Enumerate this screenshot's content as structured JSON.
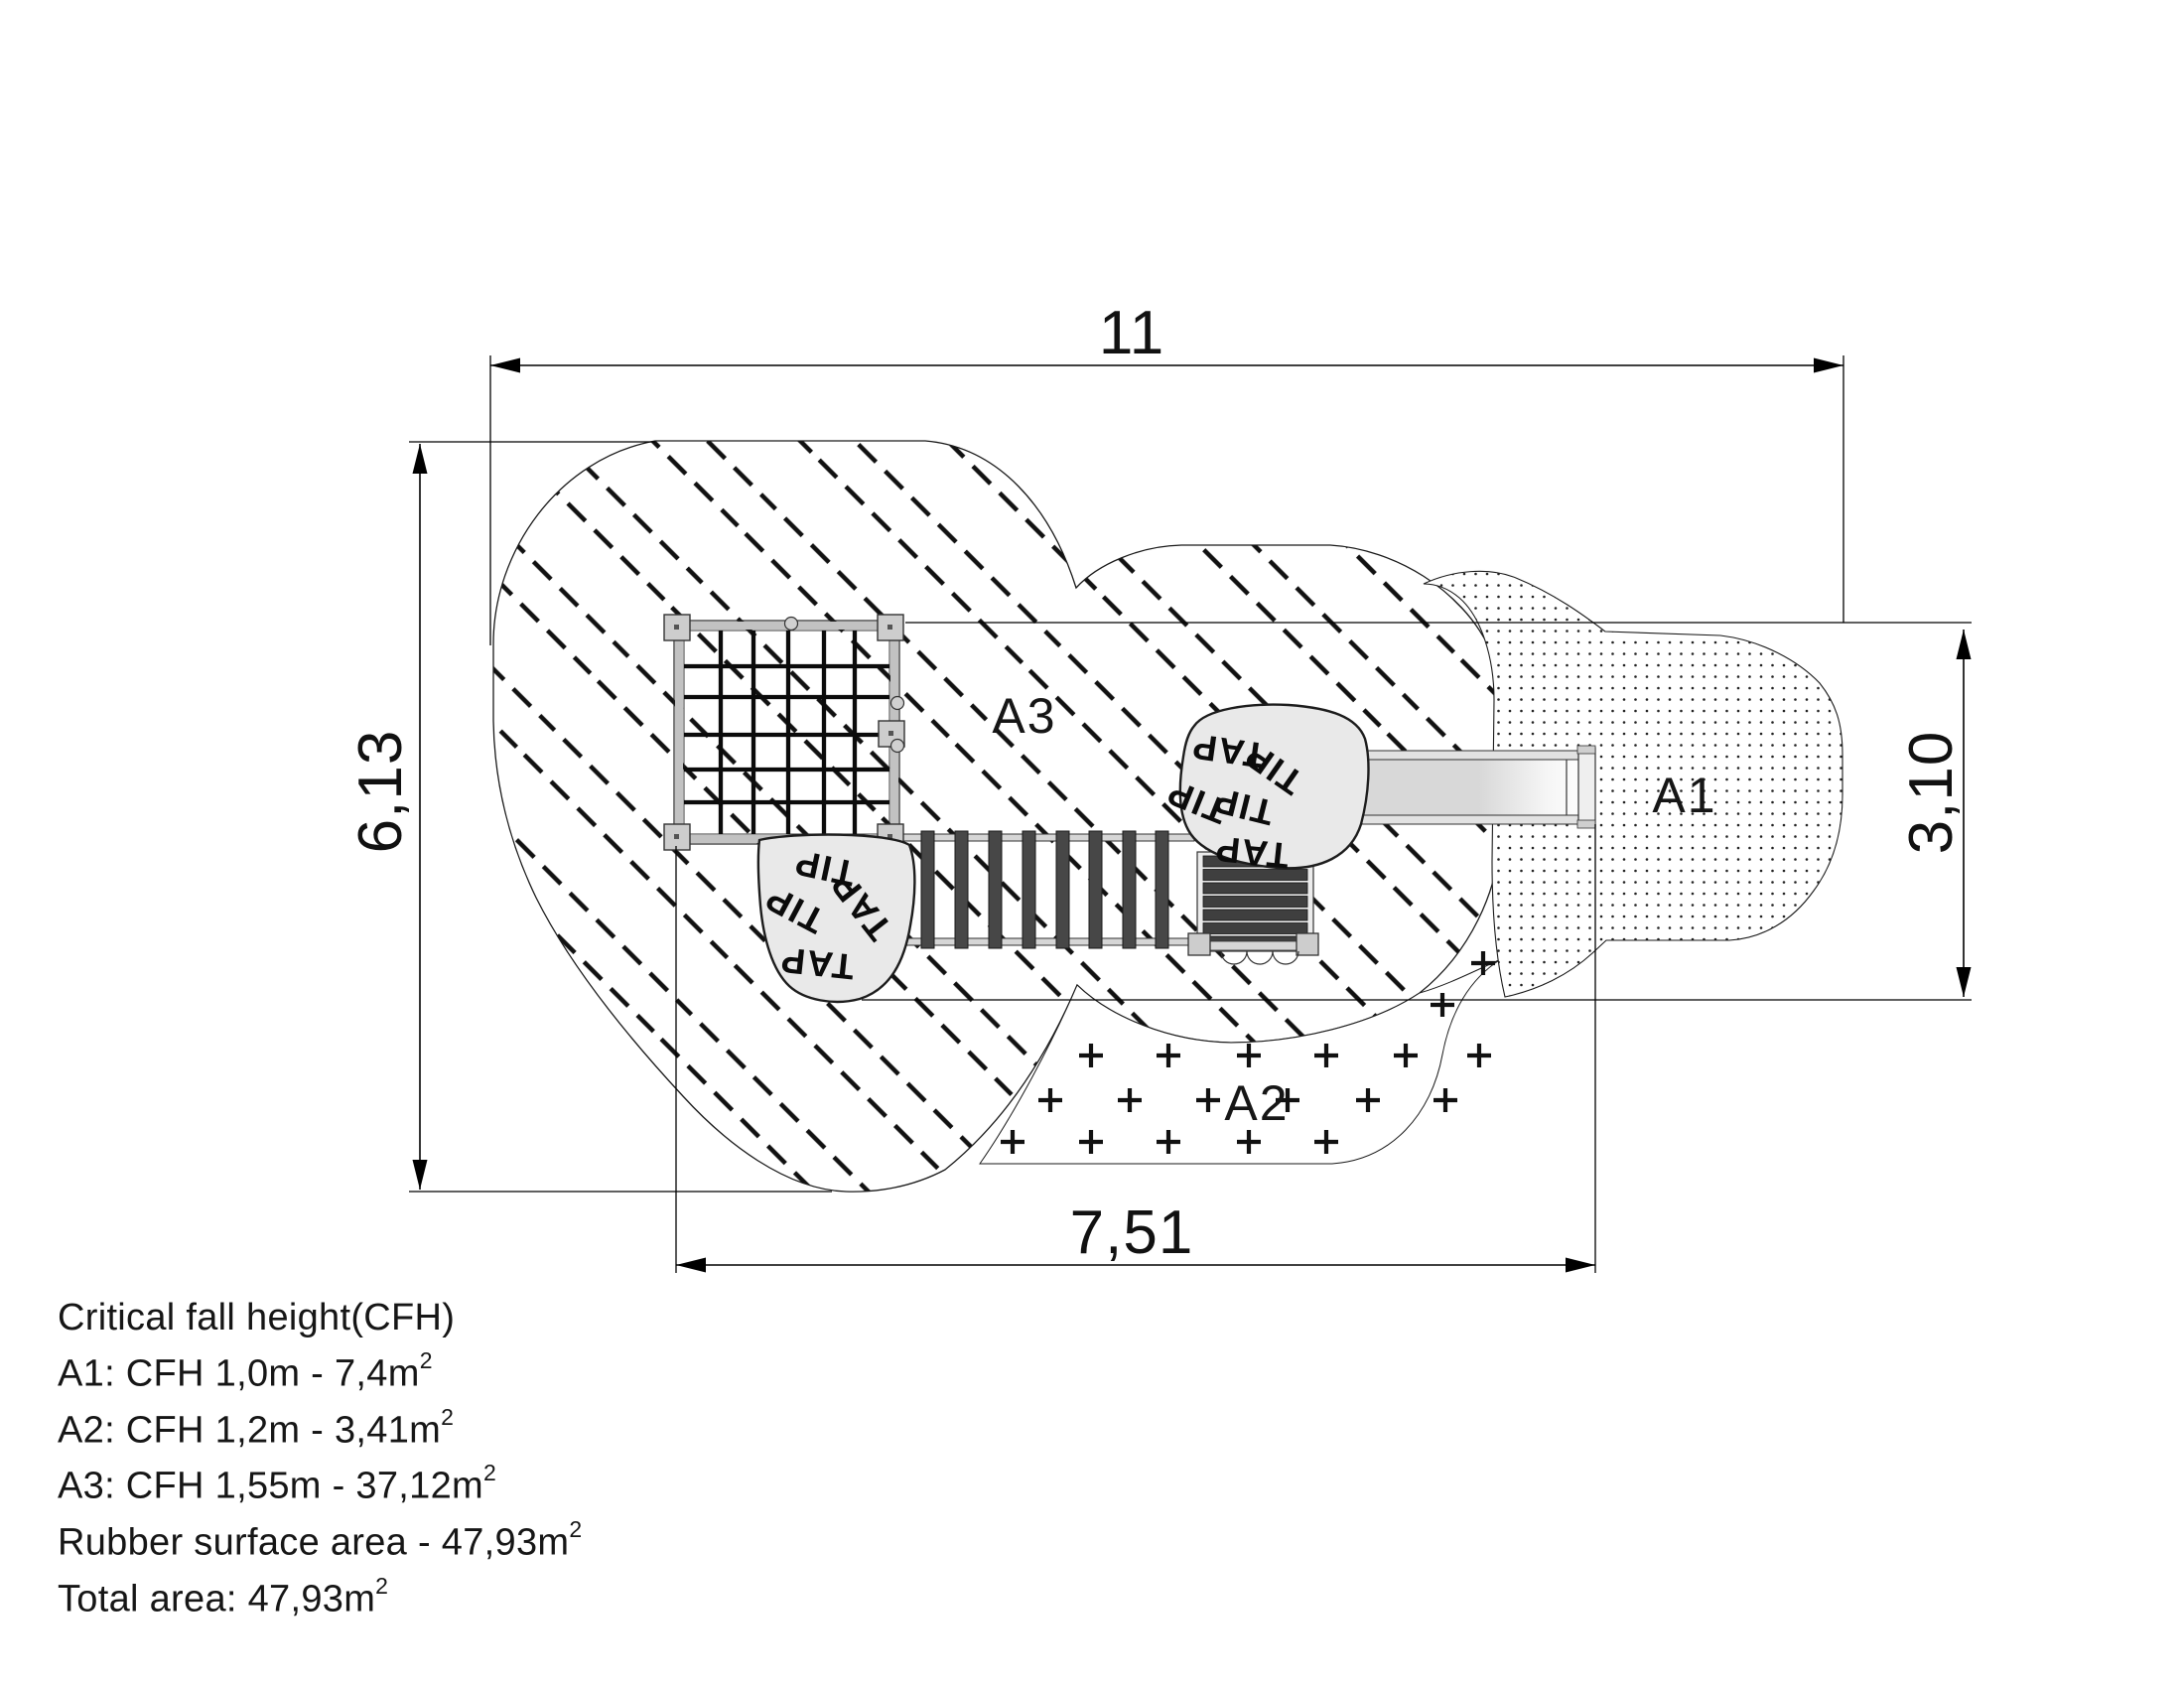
{
  "plan": {
    "dimensions": {
      "top_width": "11",
      "left_height": "6,13",
      "right_height": "3,10",
      "bottom_width": "7,51"
    },
    "area_labels": {
      "a1": "A1",
      "a2": "A2",
      "a3": "A3"
    },
    "logo_words": [
      "TIP",
      "TIP",
      "TAP"
    ]
  },
  "notes": {
    "title": "Critical fall height(CFH)",
    "lines": [
      {
        "text": "A1: CFH 1,0m - 7,4m",
        "sup": "2"
      },
      {
        "text": "A2: CFH 1,2m - 3,41m",
        "sup": "2"
      },
      {
        "text": "A3: CFH 1,55m - 37,12m",
        "sup": "2"
      },
      {
        "text": "Rubber surface area - 47,93m",
        "sup": "2"
      },
      {
        "text": "Total area: 47,93m",
        "sup": "2"
      }
    ]
  },
  "colors": {
    "line": "#000000",
    "hatch": "#111111",
    "panel_fill": "#e9e9e9",
    "rail_fill": "#d6d6d6",
    "slat_fill": "#3f3f3f",
    "plate_fill": "#cdcdcd",
    "background": "#ffffff"
  }
}
